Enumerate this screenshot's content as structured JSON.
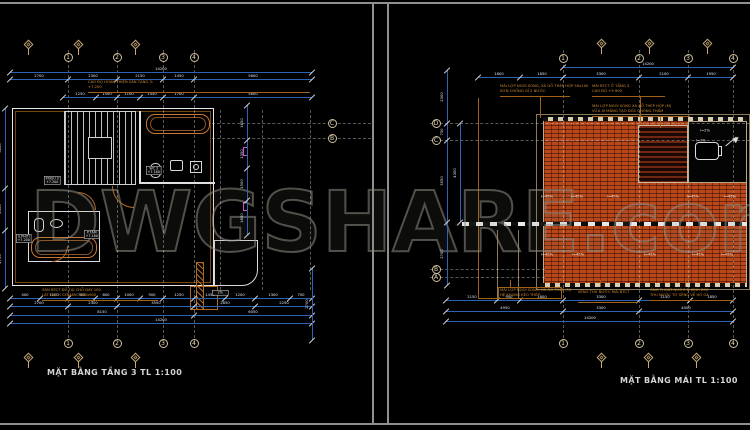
{
  "watermark": {
    "text": "DWGSHARE.com"
  },
  "colors": {
    "background": "#000000",
    "roof_tile_orange": "#b8481a",
    "dimension_blue": "#2e62b4",
    "annotation_orange": "#c87828",
    "grid_tan": "#cfc0a0",
    "wall_white": "#e6e6e6",
    "magenta_tag": "#d050d0",
    "watermark_gray": "#4a4a4a",
    "sheet_border_gray": "#8f8f8f"
  },
  "left_sheet": {
    "title": "MẶT BẰNG TẦNG 3 TL 1:100",
    "col_grid_labels": [
      "1",
      "2",
      "3",
      "4"
    ],
    "row_grid_labels": [
      "C",
      "B"
    ],
    "note_top": [
      "CAO ĐỘ HOÀN THIỆN SÀN TẦNG 3:",
      "+7.200"
    ],
    "note_bottom": [
      "SÀN BTCT ĐỔ TẠI CHỖ DÀY 100",
      "LÁT GẠCH CERAMIC 600x600"
    ],
    "room_tags": [
      [
        "P.NGỦ 3",
        "+7.200"
      ],
      [
        "WC 3",
        "+7.180"
      ],
      [
        "S.PHƠI",
        "+7.200"
      ],
      [
        "P.TẮM",
        "+7.180"
      ]
    ],
    "detail_tag": "2%",
    "dim_chains": {
      "top_total": [
        "14200"
      ],
      "top_main": [
        "2700",
        "2300",
        "2150",
        "1450",
        "5600"
      ],
      "top_inner": [
        "1250",
        "1500",
        "1100",
        "1450",
        "1700",
        "5600"
      ],
      "bottom_detail": [
        "400",
        "1100",
        "900",
        "800",
        "1000",
        "900",
        "1250",
        "1450",
        "1200",
        "1300",
        "700"
      ],
      "bottom_main": [
        "2700",
        "2300",
        "3550",
        "2850",
        "2250"
      ],
      "bottom_sub": [
        "8150",
        "6050"
      ],
      "bottom_total": [
        "14200"
      ],
      "left_vert": [
        "3800",
        "2000",
        "2750"
      ],
      "mid_vert": [
        "1650",
        "1350",
        "1500",
        "1650"
      ],
      "right_vert": [
        "2700"
      ]
    }
  },
  "right_sheet": {
    "title": "MẶT BẰNG MÁI TL 1:100",
    "col_grid_labels": [
      "1",
      "2",
      "3",
      "4"
    ],
    "row_grid_labels": [
      "D",
      "C",
      "B",
      "A"
    ],
    "notes_top": [
      [
        "MÁI LỢP NGÓI SÓNG, XÀ GỒ THÉP HỘP 50x100",
        "SƠN CHỐNG GỈ 2 NƯỚC"
      ],
      [
        "MÁI BTCT Ở TẦNG 3",
        "CAO ĐỘ +9.900"
      ],
      [
        "MÁI LỢP NGÓI SÓNG XÀ GỒ THÉP HỘP (M)",
        "VỮA XI MĂNG TẠO DỐC CHỐNG THẤM"
      ]
    ],
    "notes_bottom": [
      [
        "MÁI LỢP NGÓI SÓNG, XÀ GỒ THÉP (M)",
        "HỆ KHUNG KÈO THÉP"
      ],
      [
        "SÊNÔ THU NƯỚC MÁI BTCT"
      ],
      [
        "ỐNG THOÁT NƯỚC Đ.KÍNH D90",
        "THU NƯỚC TỪ SÊNÔ VỀ HỐ GA"
      ]
    ],
    "slope_labels_upper": [
      "i=45%",
      "i=45%",
      "i=45%",
      "i=45%",
      "i=45%"
    ],
    "slope_labels_lower": [
      "i=45%",
      "i=45%",
      "i=45%",
      "i=45%",
      "i=45%"
    ],
    "tank_labels": [
      "i=2%",
      "i=2%"
    ],
    "dim_chains": {
      "top_total": [
        "14200"
      ],
      "top_main": [
        "1800",
        "1850",
        "3300",
        "2100",
        "1950"
      ],
      "bottom_detail": [
        "2150",
        "950",
        "1800",
        "3300",
        "2150",
        "1850"
      ],
      "bottom_main": [
        "4950",
        "3300",
        "4000"
      ],
      "bottom_total": [
        "14200"
      ],
      "left_vert": [
        "2300",
        "750",
        "3550",
        "2700"
      ],
      "left_vert2": [
        "4300"
      ]
    }
  }
}
